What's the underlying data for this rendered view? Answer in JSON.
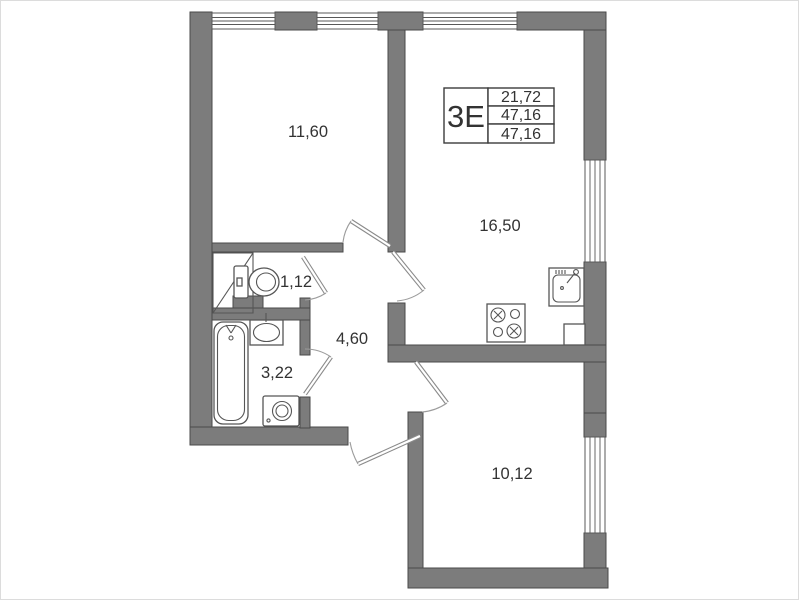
{
  "plan": {
    "unit": {
      "label": "3Е",
      "table_rows": [
        "21,72",
        "47,16",
        "47,16"
      ]
    },
    "rooms": {
      "bedroom": "11,60",
      "living_kitchen": "16,50",
      "wc": "1,12",
      "hall": "4,60",
      "bathroom": "3,22",
      "bedroom2": "10,12"
    },
    "colors": {
      "wall_fill": "#7c7c7c",
      "wall_stroke": "#4a4a4a",
      "line": "#585858",
      "text": "#333333"
    }
  }
}
